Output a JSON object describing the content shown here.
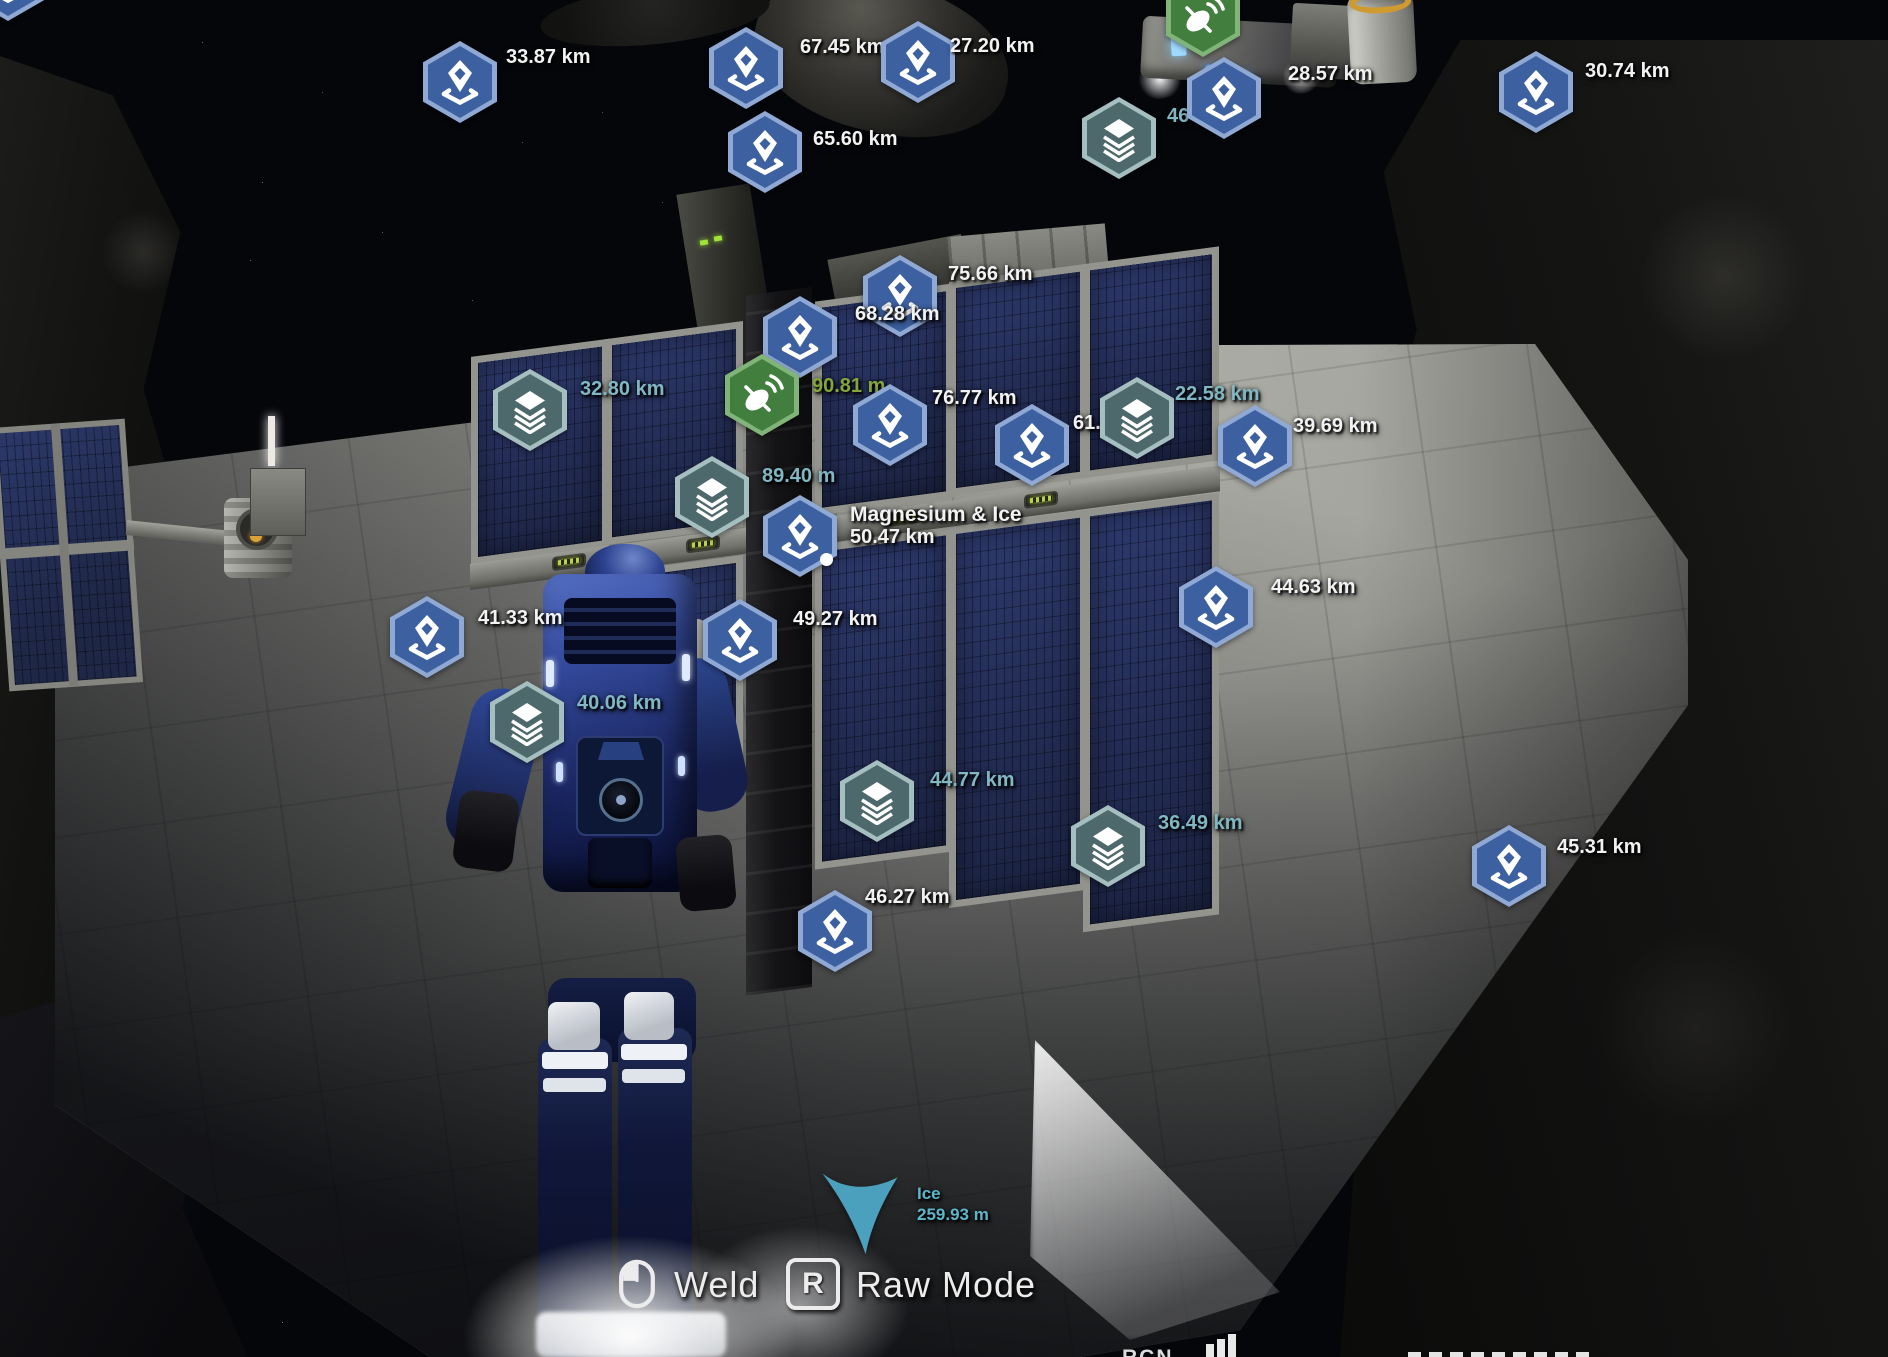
{
  "colors": {
    "gps_fill": "#3c60a0",
    "gps_border": "#8fa9d4",
    "materials_fill": "#4e696b",
    "materials_border": "#a5bec0",
    "antenna_fill": "#427e3d",
    "antenna_border": "#81b478",
    "signal_text_white": "#f2f2f2",
    "signal_text_teal": "#80b7c3",
    "signal_text_green": "#84a63b",
    "target_arrow": "#4ba0bd",
    "target_text": "#5cb6cc"
  },
  "markers": [
    {
      "variant": "gps",
      "x": 8,
      "y": -20,
      "lines": []
    },
    {
      "variant": "gps",
      "x": 460,
      "y": 82,
      "dx": 46,
      "dy": -36,
      "lines": [
        "33.87 km"
      ]
    },
    {
      "variant": "gps",
      "x": 746,
      "y": 68,
      "dx": 54,
      "dy": -32,
      "lines": [
        "67.45 km"
      ]
    },
    {
      "variant": "gps",
      "x": 918,
      "y": 62,
      "dx": 32,
      "dy": -27,
      "lines": [
        "27.20 km"
      ]
    },
    {
      "variant": "antenna",
      "x": 1203,
      "y": 16,
      "lines": []
    },
    {
      "variant": "materials",
      "x": 1119,
      "y": 138,
      "dx": 48,
      "dy": -33,
      "lines": [
        "46"
      ],
      "color": "teal"
    },
    {
      "variant": "gps",
      "x": 1224,
      "y": 98,
      "dx": 64,
      "dy": -35,
      "lines": [
        "28.57 km"
      ]
    },
    {
      "variant": "gps",
      "x": 1536,
      "y": 92,
      "dx": 49,
      "dy": -32,
      "lines": [
        "30.74 km"
      ]
    },
    {
      "variant": "gps",
      "x": 765,
      "y": 152,
      "dx": 48,
      "dy": -24,
      "lines": [
        "65.60 km"
      ]
    },
    {
      "variant": "gps",
      "x": 900,
      "y": 296,
      "dx": 48,
      "dy": -33,
      "lines": [
        "75.66 km"
      ]
    },
    {
      "variant": "gps",
      "x": 800,
      "y": 337,
      "dx": 55,
      "dy": -34,
      "lines": [
        "68.28 km"
      ]
    },
    {
      "variant": "materials",
      "x": 530,
      "y": 410,
      "dx": 50,
      "dy": -32,
      "lines": [
        "32.80 km"
      ],
      "color": "teal"
    },
    {
      "variant": "antenna",
      "x": 762,
      "y": 395,
      "dx": 50,
      "dy": -20,
      "lines": [
        "90.81 m"
      ],
      "color": "green"
    },
    {
      "variant": "gps",
      "x": 890,
      "y": 425,
      "dx": 42,
      "dy": -38,
      "lines": [
        "76.77 km"
      ]
    },
    {
      "variant": "gps",
      "x": 1032,
      "y": 445,
      "dx": 41,
      "dy": -33,
      "lines": [
        "61.09"
      ]
    },
    {
      "variant": "materials",
      "x": 1137,
      "y": 418,
      "dx": 38,
      "dy": -35,
      "lines": [
        "22.58 km"
      ],
      "color": "teal"
    },
    {
      "variant": "gps",
      "x": 1255,
      "y": 446,
      "dx": 38,
      "dy": -31,
      "lines": [
        "39.69 km"
      ]
    },
    {
      "variant": "materials",
      "x": 712,
      "y": 497,
      "dx": 50,
      "dy": -32,
      "lines": [
        "89.40 m"
      ],
      "color": "teal"
    },
    {
      "variant": "gps",
      "x": 800,
      "y": 536,
      "dx": 50,
      "dy": -33,
      "lines": [
        "Magnesium & Ice",
        "50.47 km"
      ],
      "selected": true,
      "firstBig": true
    },
    {
      "variant": "gps",
      "x": 427,
      "y": 637,
      "dx": 51,
      "dy": -30,
      "lines": [
        "41.33 km"
      ]
    },
    {
      "variant": "gps",
      "x": 740,
      "y": 640,
      "dx": 53,
      "dy": -32,
      "lines": [
        "49.27 km"
      ]
    },
    {
      "variant": "gps",
      "x": 1216,
      "y": 607,
      "dx": 55,
      "dy": -31,
      "lines": [
        "44.63 km"
      ]
    },
    {
      "variant": "materials",
      "x": 527,
      "y": 722,
      "dx": 50,
      "dy": -30,
      "lines": [
        "40.06 km"
      ],
      "color": "teal"
    },
    {
      "variant": "materials",
      "x": 877,
      "y": 801,
      "dx": 53,
      "dy": -32,
      "lines": [
        "44.77 km"
      ],
      "color": "teal"
    },
    {
      "variant": "materials",
      "x": 1108,
      "y": 846,
      "dx": 50,
      "dy": -34,
      "lines": [
        "36.49 km"
      ],
      "color": "teal"
    },
    {
      "variant": "gps",
      "x": 835,
      "y": 931,
      "dx": 30,
      "dy": -45,
      "lines": [
        "46.27 km"
      ]
    },
    {
      "variant": "gps",
      "x": 1509,
      "y": 866,
      "dx": 48,
      "dy": -30,
      "lines": [
        "45.31 km"
      ]
    },
    {
      "variant": "target",
      "x": 860,
      "y": 1213,
      "dx": 57,
      "dy": -30,
      "lines": [
        "Ice",
        "259.93 m"
      ],
      "color": "cyan"
    }
  ],
  "hud": {
    "weld_label": "Weld",
    "raw_mode_label": "Raw Mode",
    "key_r": "R",
    "clipped_left": "RCN"
  }
}
